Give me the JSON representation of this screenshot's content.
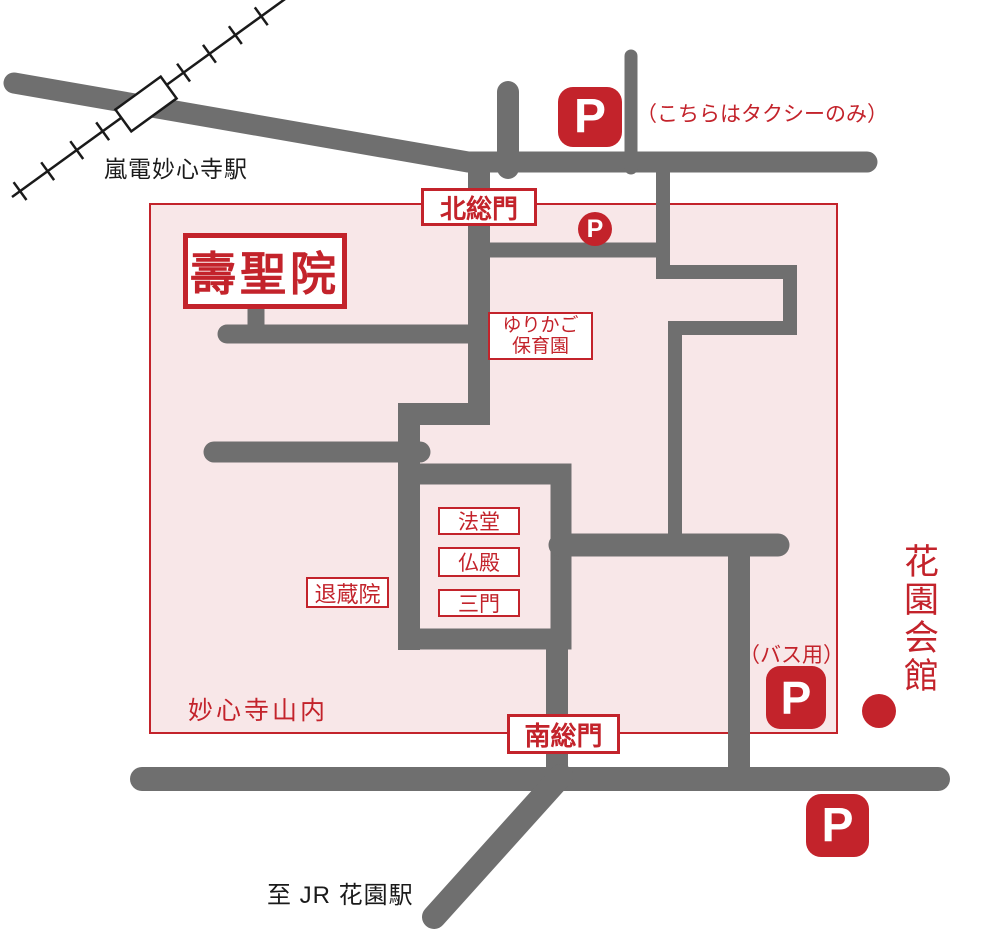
{
  "colors": {
    "red": "#c3232b",
    "road_gray": "#6f6f6f",
    "precinct_pink": "#f8e7e8",
    "rail_black": "#1a1a1a"
  },
  "railway": {
    "station_name": "嵐電妙心寺駅"
  },
  "precinct": {
    "name": "妙心寺山内",
    "north_gate": "北総門",
    "south_gate": "南総門"
  },
  "temple": {
    "name": "壽聖院"
  },
  "nursery": {
    "line1": "ゆりかご",
    "line2": "保育園"
  },
  "buildings": {
    "hatto": "法堂",
    "butsuden": "仏殿",
    "sanmon": "三門",
    "taizoin": "退蔵院"
  },
  "parking": {
    "glyph": "P",
    "taxi_note": "（こちらはタクシーのみ）",
    "bus_note": "（バス用）"
  },
  "landmarks": {
    "hanazono_hall": "花園会館",
    "to_jr_station": "至 JR 花園駅"
  }
}
